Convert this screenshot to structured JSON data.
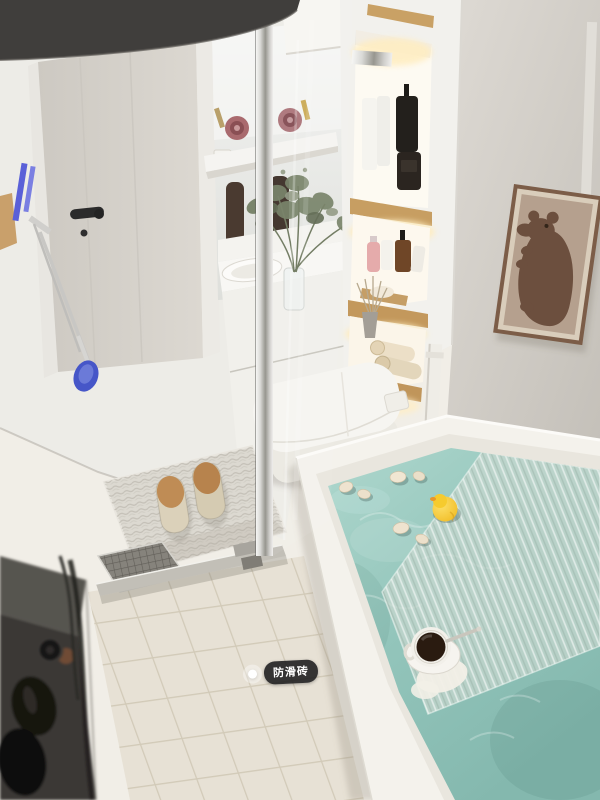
{
  "scene": {
    "type": "3d-render-bathroom-interior",
    "view": "high-angle view of compact bathroom with wet/dry separation",
    "annotation_tag": {
      "label": "防滑砖",
      "translation": "anti-slip tile",
      "marker": "white-dot",
      "pill_color": "#161619",
      "text_color": "#ffffff"
    },
    "palette": {
      "wall_left": "#edece7",
      "wall_right": "#d3cfc8",
      "floor": "#f1eee7",
      "tile": "#ece7db",
      "tile_grout": "#d6cfbd",
      "tub_white": "#f4f2ec",
      "water_teal": "#93c5bb",
      "tray_green": "#cbd8d0",
      "wood_shelf": "#c79e62",
      "warm_light": "#ffedc0",
      "lamp_shade": "#403e3c",
      "duck_yellow": "#f3bd19",
      "poster_frame": "#7c5d48",
      "poster_bg": "#b5a08e",
      "bear_brown": "#6c4f3e",
      "slipper_toe": "#bf8c55",
      "pink_bottle": "#e5abab",
      "amber_bottle": "#6f4627",
      "coffee": "#2a1b10"
    },
    "objects": [
      {
        "id": "pendant-lamp",
        "label": "dark pendant lamp shade (foreground top-left)"
      },
      {
        "id": "bathroom-door",
        "label": "light grey bathroom door with black handle"
      },
      {
        "id": "cleaning-tools",
        "label": "wall-hung cleaning brushes and squeegee"
      },
      {
        "id": "mirror",
        "label": "frameless vanity mirror"
      },
      {
        "id": "wall-shelf",
        "label": "white shelf with rolled towels and bottles"
      },
      {
        "id": "vanity",
        "label": "white vanity cabinet with basin"
      },
      {
        "id": "plant-vase",
        "label": "glass vase with green sprigs"
      },
      {
        "id": "shower-glass",
        "label": "glass shower partition with chrome post"
      },
      {
        "id": "recessed-shelves",
        "label": "backlit wooden niche shelves with toiletries"
      },
      {
        "id": "reed-diffuser",
        "label": "reed diffuser and rolled towels"
      },
      {
        "id": "bear-poster",
        "label": "framed brown bear art print"
      },
      {
        "id": "wall-pipe",
        "label": "white wall pipe beside tub"
      },
      {
        "id": "toilet",
        "label": "white smart toilet"
      },
      {
        "id": "bath-mat",
        "label": "woven bath mat"
      },
      {
        "id": "slippers",
        "label": "pair of beige slippers"
      },
      {
        "id": "tile-floor",
        "label": "anti-slip square tile shower floor"
      },
      {
        "id": "floor-drain",
        "label": "floor drain grate and glass track"
      },
      {
        "id": "bathtub",
        "label": "white built-in bathtub with teal water"
      },
      {
        "id": "bath-tray",
        "label": "translucent ribbed bath tray"
      },
      {
        "id": "rubber-duck",
        "label": "yellow rubber duck"
      },
      {
        "id": "floating-shells",
        "label": "small floating shells"
      },
      {
        "id": "coffee-cup",
        "label": "white cup of black coffee with spoon"
      },
      {
        "id": "storage-cart",
        "label": "dark cart with black bottles (blurred foreground)"
      }
    ]
  }
}
